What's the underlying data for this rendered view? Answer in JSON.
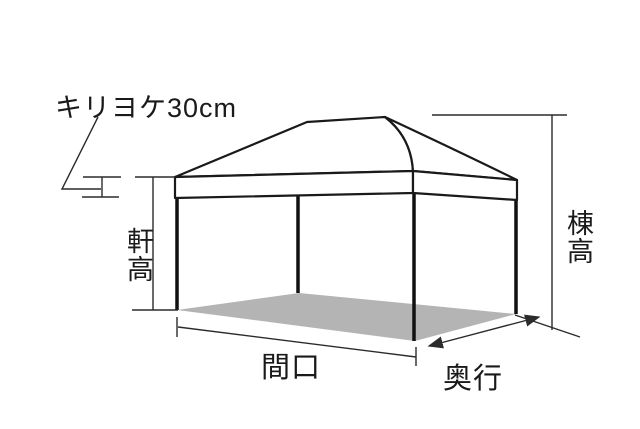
{
  "diagram": {
    "type": "tent-dimension-diagram",
    "annotation_note": "キリヨケ30cm",
    "labels": {
      "eave_height": "軒高",
      "ridge_height": "棟高",
      "frontage": "間口",
      "depth": "奥行"
    },
    "colors": {
      "background": "#ffffff",
      "line": "#1a1a1a",
      "dimension_line": "#2b2b2b",
      "floor_shadow": "#b4b4b4"
    }
  }
}
